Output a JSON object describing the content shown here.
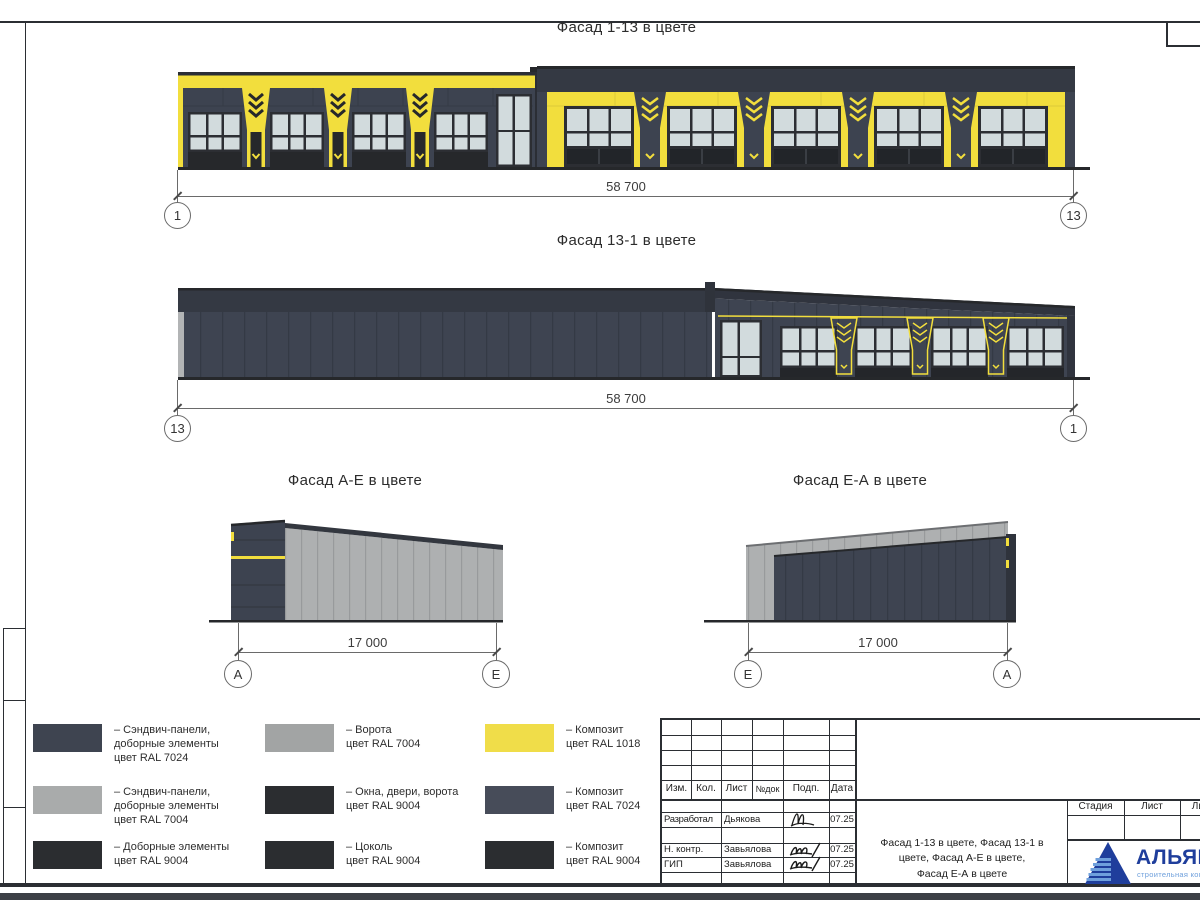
{
  "colors": {
    "ral7024": "#3d4350",
    "ral7024_band": "#343943",
    "ral7004": "#aeb0b1",
    "ral9004": "#27292c",
    "ral1018": "#f2de3d",
    "glazing": "#d2dbdd",
    "frame_line": "#2b2e33",
    "dim_line": "#6a6a6a",
    "logo_blue": "#1f3e9c",
    "logo_light_blue": "#6fa0dc"
  },
  "views": [
    {
      "title": "Фасад 1-13 в цвете",
      "dimension": "58 700",
      "axis_left": "1",
      "axis_right": "13"
    },
    {
      "title": "Фасад 13-1 в цвете",
      "dimension": "58 700",
      "axis_left": "13",
      "axis_right": "1"
    },
    {
      "title": "Фасад А-Е в цвете",
      "dimension": "17 000",
      "axis_left": "А",
      "axis_right": "Е"
    },
    {
      "title": "Фасад Е-А в цвете",
      "dimension": "17 000",
      "axis_left": "Е",
      "axis_right": "А"
    }
  ],
  "legend": [
    {
      "color": "#3e4450",
      "label": "– Сэндвич-панели,\nдоборные элементы\nцвет RAL 7024"
    },
    {
      "color": "#a2a4a4",
      "label": "– Ворота\nцвет RAL 7004"
    },
    {
      "color": "#f0dd49",
      "label": "– Композит\nцвет RAL 1018"
    },
    {
      "color": "#a9abab",
      "label": "– Сэндвич-панели,\nдоборные элементы\nцвет RAL 7004"
    },
    {
      "color": "#2b2d30",
      "label": "– Окна, двери, ворота\nцвет RAL 9004"
    },
    {
      "color": "#474c59",
      "label": "– Композит\nцвет RAL 7024"
    },
    {
      "color": "#2b2d30",
      "label": "– Доборные элементы\nцвет RAL 9004"
    },
    {
      "color": "#2b2d30",
      "label": "– Цоколь\nцвет RAL 9004"
    },
    {
      "color": "#2b2d30",
      "label": "– Композит\nцвет RAL 9004"
    }
  ],
  "stamp": {
    "header_cols": [
      "Изм.",
      "Кол.",
      "Лист",
      "№док",
      "Подп.",
      "Дата"
    ],
    "sign_rows": [
      {
        "role": "Разработал",
        "name": "Дьякова",
        "date": "07.25"
      },
      {
        "role": "Н. контр.",
        "name": "Завьялова",
        "date": "07.25"
      },
      {
        "role": "ГИП",
        "name": "Завьялова",
        "date": "07.25"
      }
    ],
    "stage_label": "Стадия",
    "sheet_label": "Лист",
    "sheets_label": "Листов",
    "doc_title": "Фасад 1-13 в цвете, Фасад 13-1 в\nцвете, Фасад А-Е в цвете,\nФасад Е-А в цвете",
    "logo_name": "АЛЬЯНС",
    "logo_subtitle": "строительная компания"
  }
}
